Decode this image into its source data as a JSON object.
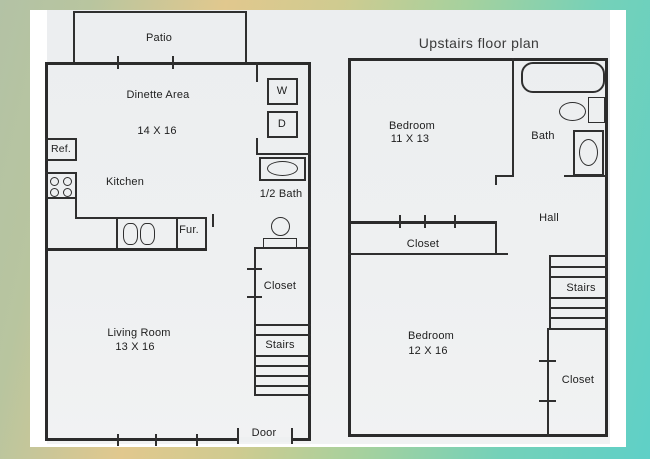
{
  "image_type": "scanned apartment floor plan photo with gradient border",
  "downstairs": {
    "patio": "Patio",
    "dinette_area": "Dinette Area",
    "dinette_size": "14 X 16",
    "washer": "W",
    "dryer": "D",
    "fridge": "Ref.",
    "kitchen": "Kitchen",
    "half_bath": "1/2 Bath",
    "furnace": "Fur.",
    "closet": "Closet",
    "stairs": "Stairs",
    "living_room": "Living Room",
    "living_room_size": "13 X 16",
    "door": "Door"
  },
  "upstairs": {
    "title": "Upstairs floor plan",
    "bedroom_small": "Bedroom",
    "bedroom_small_size": "11 X 13",
    "bath": "Bath",
    "hall": "Hall",
    "closet_hall": "Closet",
    "stairs": "Stairs",
    "bedroom_large": "Bedroom",
    "bedroom_large_size": "12 X 16",
    "closet_bedroom": "Closet"
  },
  "colors": {
    "frame_green": "#b3c2a5",
    "frame_tan": "#e1c88e",
    "frame_teal": "#5fd0c7",
    "photo_white": "#ffffff",
    "scan_paper": "#eef0f1",
    "ink": "#2f2f2f"
  }
}
